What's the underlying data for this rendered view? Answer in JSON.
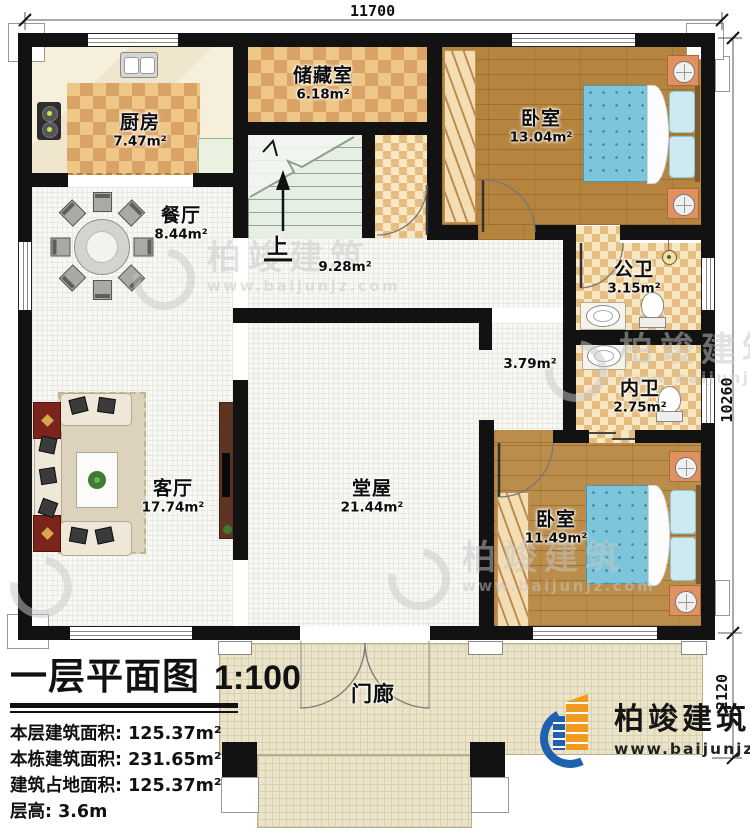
{
  "dimensions": {
    "top": "11700",
    "right": "10260",
    "right_lower": "2120"
  },
  "rooms": {
    "kitchen": {
      "name": "厨房",
      "area": "7.47m²"
    },
    "dining": {
      "name": "餐厅",
      "area": "8.44m²"
    },
    "storage": {
      "name": "储藏室",
      "area": "6.18m²"
    },
    "bedroom_top": {
      "name": "卧室",
      "area": "13.04m²"
    },
    "public_bath": {
      "name": "公卫",
      "area": "3.15m²"
    },
    "inner_bath": {
      "name": "内卫",
      "area": "2.75m²"
    },
    "bedroom_bottom": {
      "name": "卧室",
      "area": "11.49m²"
    },
    "living_room": {
      "name": "客厅",
      "area": "17.74m²"
    },
    "hall": {
      "name": "堂屋",
      "area": "21.44m²"
    },
    "porch": {
      "name": "门廊"
    },
    "corridor": {
      "area": "9.28m²"
    },
    "passage": {
      "area": "3.79m²"
    },
    "stairs": {
      "up_label": "上"
    }
  },
  "title_block": {
    "title": "一层平面图",
    "scale": "1:100",
    "stats": [
      {
        "label": "本层建筑面积:",
        "value": "125.37m²"
      },
      {
        "label": "本栋建筑面积:",
        "value": "231.65m²"
      },
      {
        "label": "建筑占地面积:",
        "value": "125.37m²"
      },
      {
        "label": "层高:",
        "value": "3.6m"
      }
    ]
  },
  "branding": {
    "company": "柏竣建筑",
    "website": "www.baijunjz.com"
  },
  "watermark": {
    "company": "柏竣建筑",
    "website": "www.baijunjz.com"
  },
  "colors": {
    "wall": "#121212",
    "checker_dark": "#d9a365",
    "checker_light": "#eec687",
    "wood": "#b5853f",
    "bed_blue": "#7cc5da",
    "logo_blue": "#1f61ae",
    "logo_orange": "#f29a1d"
  }
}
